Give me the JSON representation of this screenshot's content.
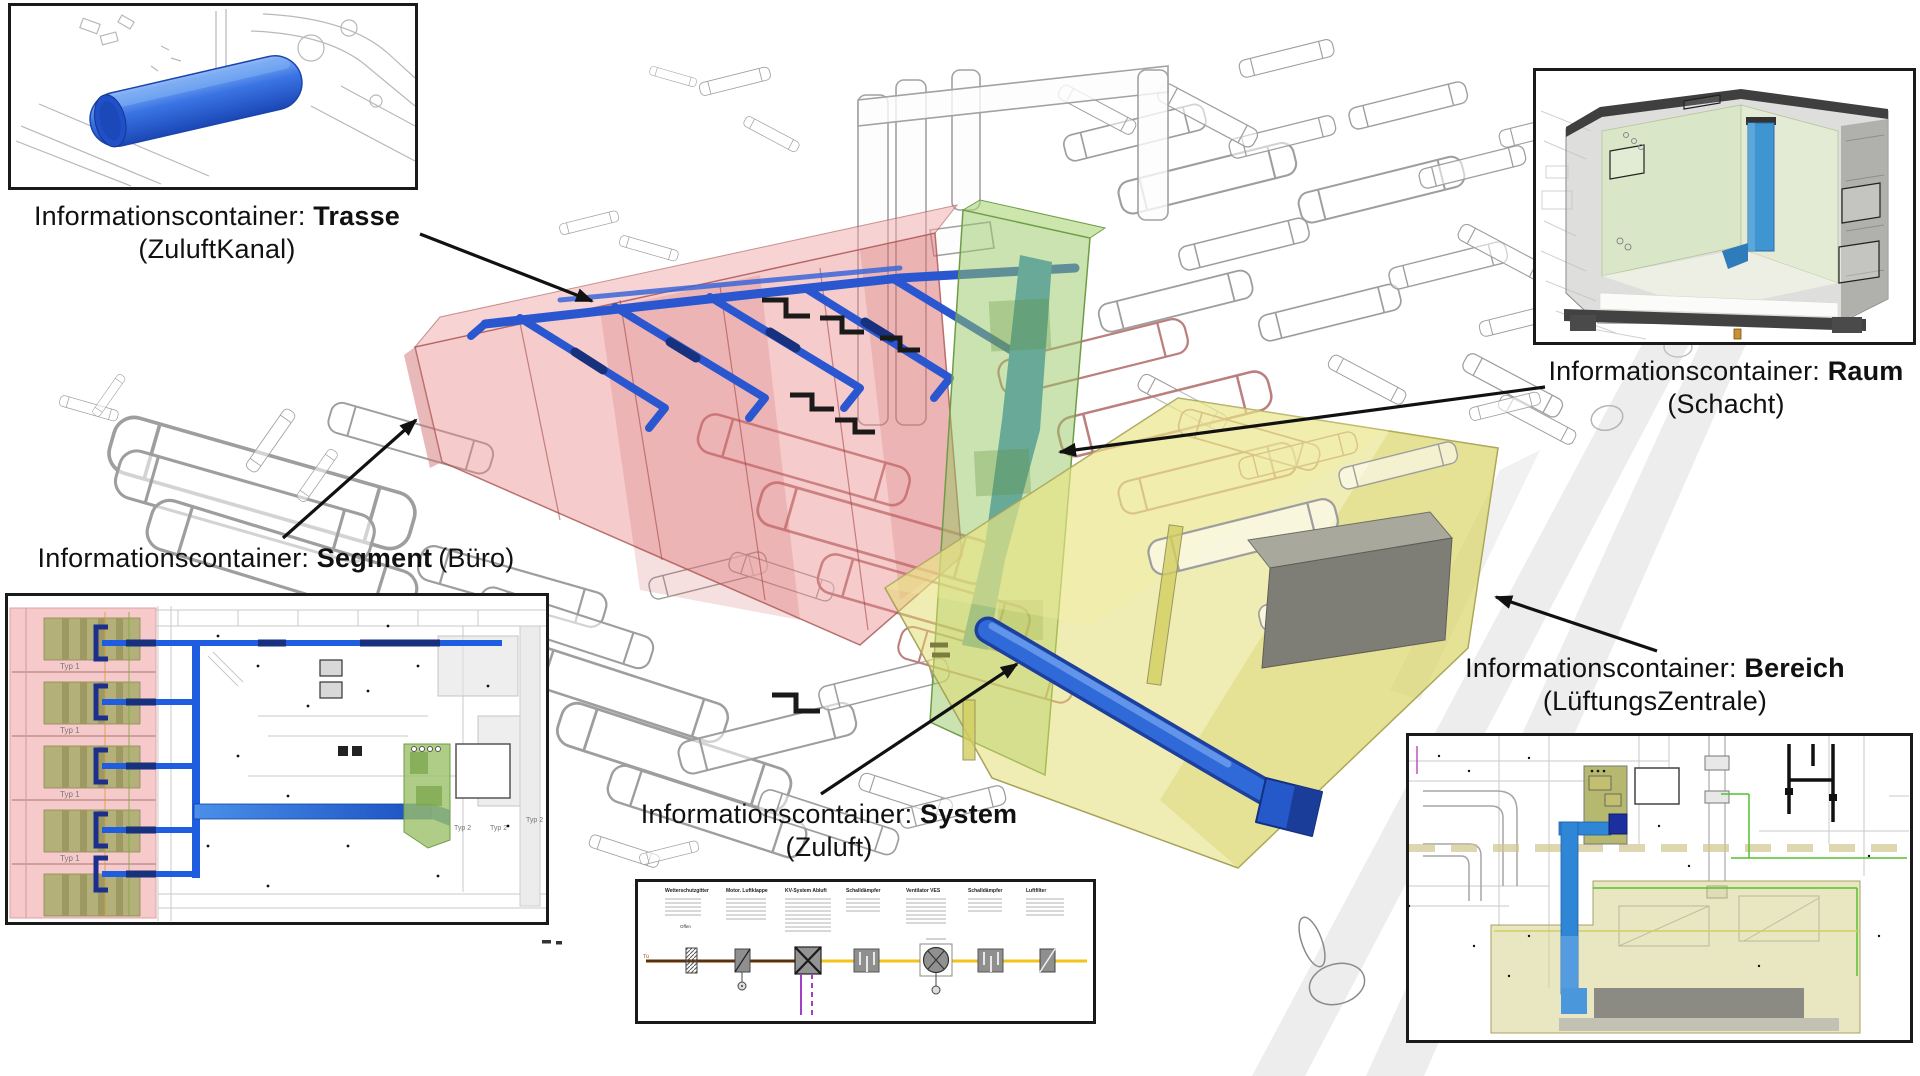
{
  "page": {
    "background": "#ffffff"
  },
  "callouts": {
    "trasse": {
      "prefix": "Informationscontainer: ",
      "type": "Trasse",
      "qualifier": "(ZuluftKanal)"
    },
    "segment": {
      "prefix": "Informationscontainer: ",
      "type": "Segment",
      "qualifier": "(Büro)"
    },
    "raum": {
      "prefix": "Informationscontainer: ",
      "type": "Raum",
      "qualifier": "(Schacht)"
    },
    "system": {
      "prefix": "Informationscontainer: ",
      "type": "System",
      "qualifier": "(Zuluft)"
    },
    "bereich": {
      "prefix": "Informationscontainer: ",
      "type": "Bereich",
      "qualifier": "(LüftungsZentrale)"
    }
  },
  "insets": {
    "segment_plan": {
      "room_labels": [
        "Typ 1",
        "Typ 1",
        "Typ 1",
        "Typ 1"
      ],
      "zone_labels": [
        "Typ 2",
        "Typ 2",
        "Typ 2"
      ]
    },
    "system_schematic": {
      "components": [
        "Wetterschutzgitter",
        "Motor. Luftklappe",
        "KV-System Abluft",
        "Schalldämpfer",
        "Ventilator VES",
        "Schalldämpfer",
        "Luftfilter"
      ],
      "inlet_label": "Tü",
      "valve_note": "Offen"
    }
  },
  "colors": {
    "arrow_black": "#111111",
    "duct_blue": "#2a57cf",
    "duct_blue_dark": "#17317e",
    "trasse_cylinder_blue": "#2e6be0",
    "segment_red": "#e98585",
    "raum_green": "#8fc25e",
    "bereich_yellow": "#dedb7a",
    "schematic_supply_yellow": "#f2c41a",
    "schematic_exhaust_brown": "#6b3a14",
    "schematic_control_purple": "#a33fc2"
  }
}
